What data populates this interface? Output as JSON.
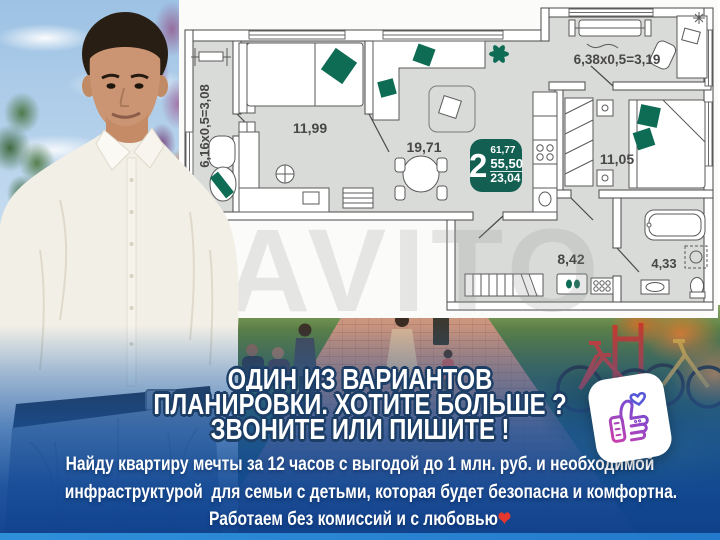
{
  "floorplan": {
    "balcony_left_dim": "6,16x0,5=3,08",
    "balcony_right_dim": "6,38x0,5=3,19",
    "rooms": {
      "bedroom_left": "11,99",
      "living": "19,71",
      "bedroom_right": "11,05",
      "hall": "8,42",
      "bath": "4,33"
    },
    "badge": {
      "rooms_count": "2",
      "total_area": "61,77",
      "living_area": "55,50",
      "kitchen_area": "23,04"
    }
  },
  "watermark": "AVITO",
  "headline": {
    "line1": "ОДИН ИЗ ВАРИАНТОВ",
    "line2": "ПЛАНИРОВКИ. ХОТИТЕ БОЛЬШЕ ?",
    "line3": "ЗВОНИТЕ ИЛИ ПИШИТЕ !"
  },
  "body": {
    "line1": "Найду квартиру мечты за 12 часов с выгодой до 1 млн. руб. и необходимой",
    "line2": "инфраструктурой  для семьи с детьми, которая будет безопасна и комфортна.",
    "line3": "Работаем без комиссий и с любовью",
    "heart": "❤"
  },
  "colors": {
    "badge_green": "#136053",
    "plan_accent_green": "#0e6b54",
    "overlay_blue": "#1a60b2",
    "headline_outline": "#1c3e66",
    "heart_red": "#e5372e"
  },
  "sticker": {
    "icon": "thumbs-up-with-heart"
  }
}
